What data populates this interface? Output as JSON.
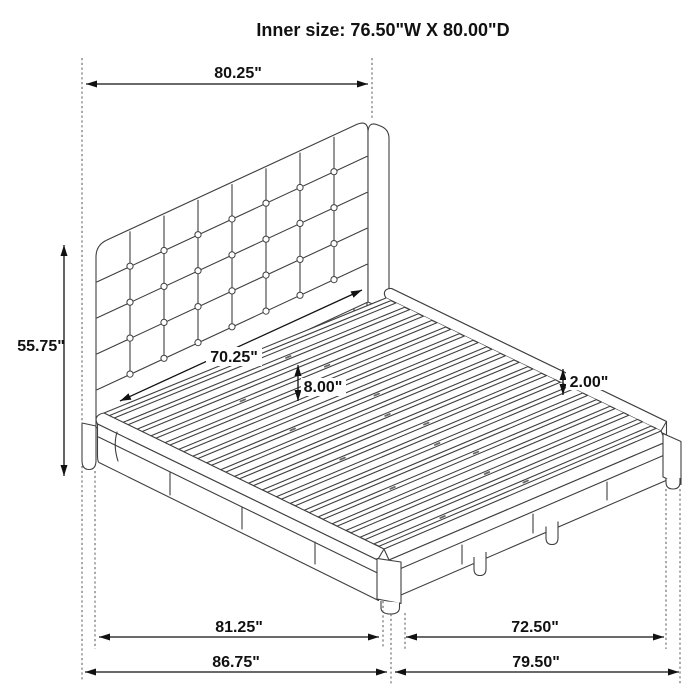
{
  "title": "Inner size: 76.50\"W X 80.00\"D",
  "dimensions": {
    "headboard_width": "80.25\"",
    "headboard_height": "55.75\"",
    "inner_slat_width": "70.25\"",
    "slat_platform_height": "8.00\"",
    "side_rail_height": "2.00\"",
    "base_length": "81.25\"",
    "overall_length": "86.75\"",
    "base_width": "72.50\"",
    "overall_width": "79.50\""
  }
}
